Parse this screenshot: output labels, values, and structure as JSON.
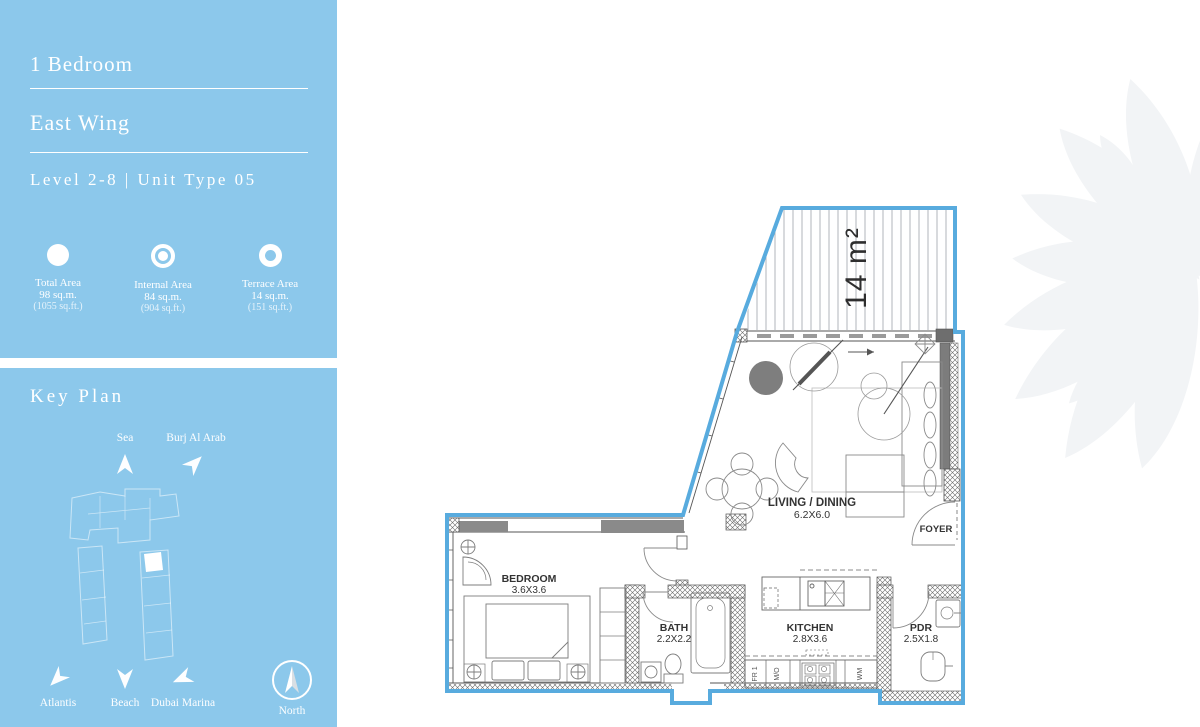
{
  "colors": {
    "sidebar_bg": "#8CC8EB",
    "plan_outline": "#58ABDE",
    "wall_gray": "#8A8A8A",
    "accent_dark": "#555555"
  },
  "sidebar": {
    "title": "1 Bedroom",
    "wing": "East Wing",
    "level": "Level 2-8 | Unit Type 05",
    "areas": [
      {
        "label": "Total Area",
        "sqm": "98 sq.m.",
        "sqft": "(1055 sq.ft.)",
        "icon": "circle-filled"
      },
      {
        "label": "Internal Area",
        "sqm": "84 sq.m.",
        "sqft": "(904 sq.ft.)",
        "icon": "circle-dot"
      },
      {
        "label": "Terrace Area",
        "sqm": "14 sq.m.",
        "sqft": "(151 sq.ft.)",
        "icon": "circle-ring"
      }
    ],
    "key_plan": {
      "title": "Key Plan",
      "markers": [
        {
          "label": "Sea",
          "direction": "up"
        },
        {
          "label": "Burj Al Arab",
          "direction": "up-right"
        },
        {
          "label": "Atlantis",
          "direction": "down-left"
        },
        {
          "label": "Beach",
          "direction": "down"
        },
        {
          "label": "Dubai Marina",
          "direction": "left-down"
        },
        {
          "label": "North",
          "direction": "up"
        }
      ]
    }
  },
  "plan": {
    "terrace": {
      "area_label": "14 m²"
    },
    "living": {
      "name": "LIVING / DINING",
      "dims": "6.2X6.0"
    },
    "foyer": {
      "name": "FOYER"
    },
    "bedroom": {
      "name": "BEDROOM",
      "dims": "3.6X3.6"
    },
    "bath": {
      "name": "BATH",
      "dims": "2.2X2.2"
    },
    "kitchen": {
      "name": "KITCHEN",
      "dims": "2.8X3.6"
    },
    "pdr": {
      "name": "PDR",
      "dims": "2.5X1.8"
    },
    "appliances": {
      "fridge": "FR 1",
      "micro": "M/O",
      "washer": "WM"
    }
  }
}
